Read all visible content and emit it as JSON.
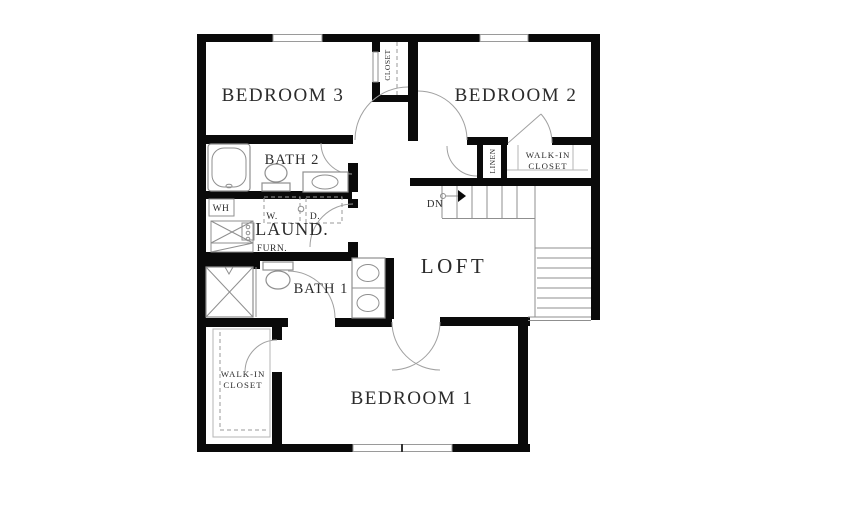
{
  "document": {
    "type": "floor-plan",
    "level": "second-floor"
  },
  "colors": {
    "wall": "#0a0a0a",
    "thin_line": "#8f8f8f",
    "fixture_line": "#9a9a9a",
    "text": "#2b2b2b",
    "background": "#ffffff"
  },
  "rooms": {
    "bedroom3": {
      "label": "BEDROOM 3"
    },
    "bedroom2": {
      "label": "BEDROOM 2"
    },
    "bedroom1": {
      "label": "BEDROOM 1"
    },
    "bath2": {
      "label": "BATH 2"
    },
    "bath1": {
      "label": "BATH 1"
    },
    "loft": {
      "label": "LOFT"
    },
    "laundry": {
      "label": "LAUND."
    },
    "walk_in_top": {
      "line1": "WALK-IN",
      "line2": "CLOSET"
    },
    "walk_in_bottom": {
      "line1": "WALK-IN",
      "line2": "CLOSET"
    },
    "closet": {
      "label": "CLOSET"
    },
    "linen": {
      "label": "LINEN"
    }
  },
  "fixtures": {
    "water_heater": "WH",
    "washer": "W.",
    "dryer": "D.",
    "furnace": "FURN."
  },
  "stairs": {
    "direction": "DN"
  }
}
